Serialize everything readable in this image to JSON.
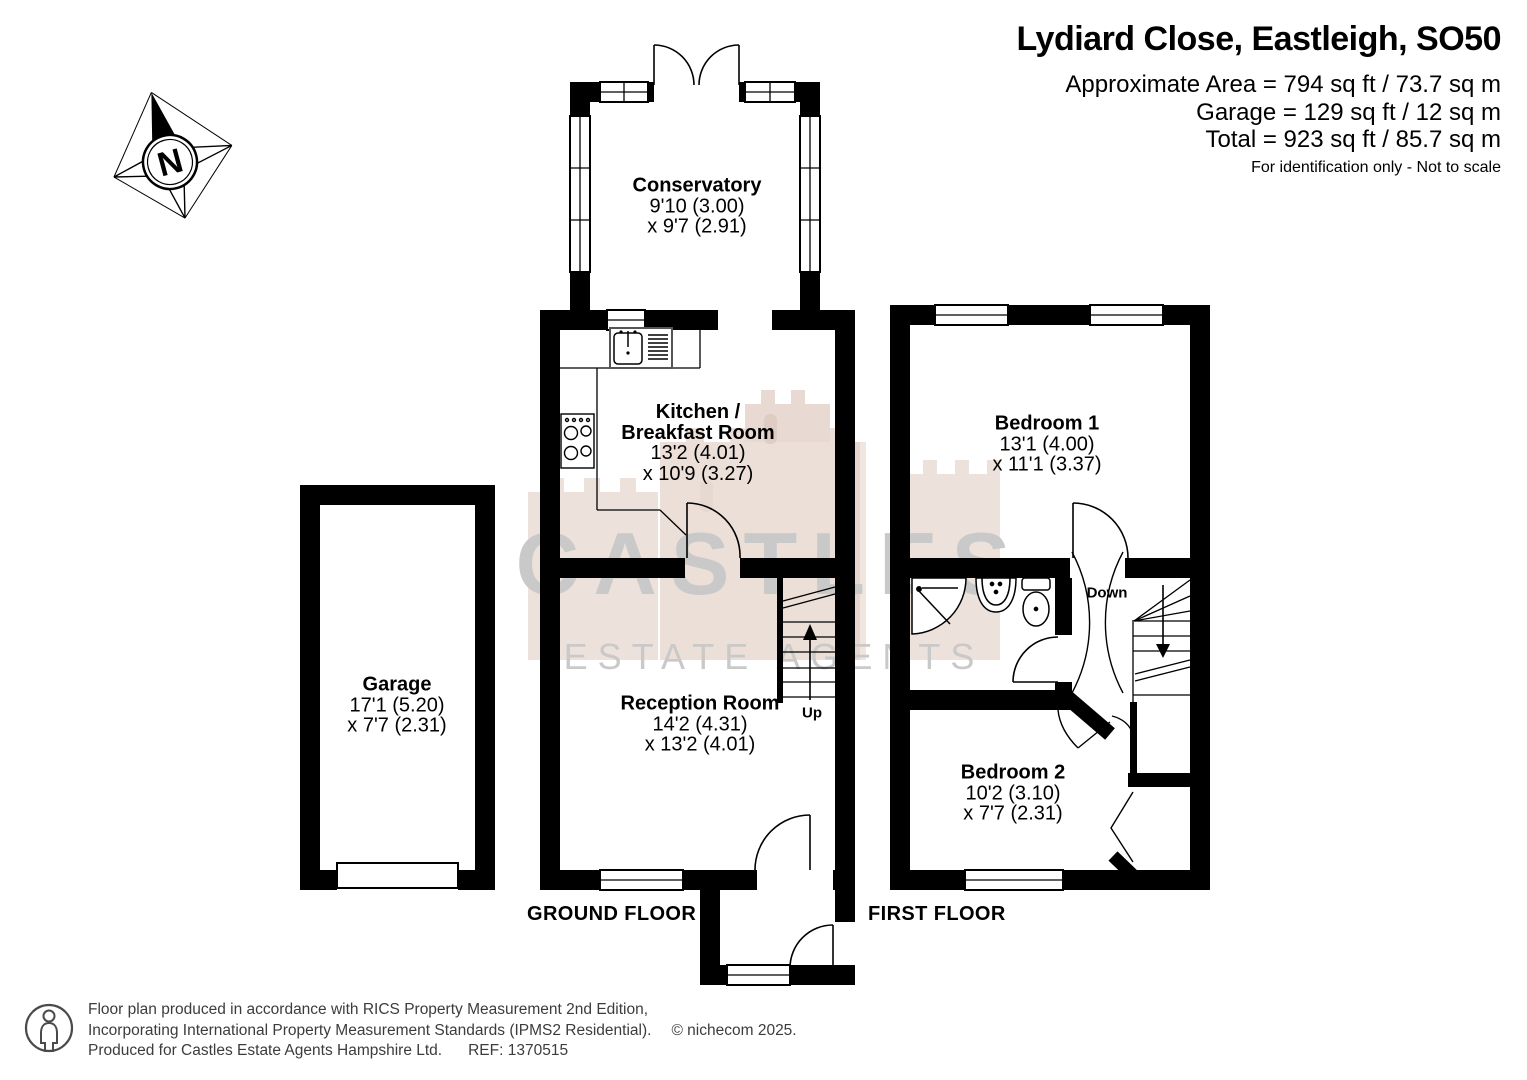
{
  "colors": {
    "wall": "#000000",
    "background": "#ffffff",
    "watermark_text": "#c9c9c9",
    "watermark_castle": "#d8c0b2"
  },
  "header": {
    "title": "Lydiard Close, Eastleigh, SO50",
    "area_lines": [
      "Approximate Area = 794 sq ft / 73.7 sq m",
      "Garage = 129 sq ft / 12 sq m",
      "Total = 923 sq ft / 85.7 sq m"
    ],
    "disclaimer": "For identification only - Not to scale"
  },
  "compass": {
    "label": "N"
  },
  "watermark": {
    "line1": "CASTLES",
    "line2": "ESTATE AGENTS"
  },
  "ground_floor": {
    "label": "GROUND FLOOR",
    "stairs_label": "Up",
    "conservatory": {
      "name": "Conservatory",
      "dim1": "9'10 (3.00)",
      "dim2": "x 9'7 (2.91)"
    },
    "kitchen": {
      "name1": "Kitchen /",
      "name2": "Breakfast Room",
      "dim1": "13'2 (4.01)",
      "dim2": "x 10'9 (3.27)"
    },
    "reception": {
      "name": "Reception Room",
      "dim1": "14'2 (4.31)",
      "dim2": "x 13'2 (4.01)"
    },
    "garage": {
      "name": "Garage",
      "dim1": "17'1 (5.20)",
      "dim2": "x 7'7 (2.31)"
    }
  },
  "first_floor": {
    "label": "FIRST FLOOR",
    "stairs_label": "Down",
    "bedroom1": {
      "name": "Bedroom 1",
      "dim1": "13'1 (4.00)",
      "dim2": "x 11'1 (3.37)"
    },
    "bedroom2": {
      "name": "Bedroom 2",
      "dim1": "10'2 (3.10)",
      "dim2": "x 7'7 (2.31)"
    }
  },
  "footer": {
    "line1": "Floor plan produced in accordance with RICS Property Measurement 2nd Edition,",
    "line2": "Incorporating International Property Measurement Standards (IPMS2 Residential).",
    "copyright": "© nichecom 2025.",
    "line3": "Produced for Castles Estate Agents Hampshire Ltd.",
    "ref": "REF:  1370515"
  }
}
